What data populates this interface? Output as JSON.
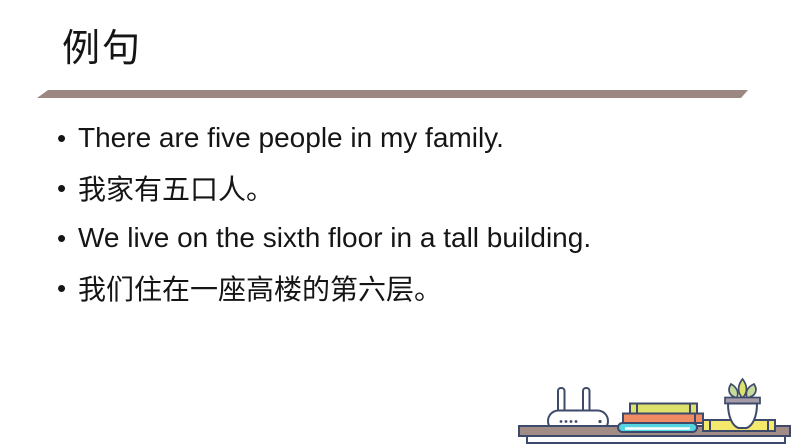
{
  "slide": {
    "title": "例句",
    "bullet_char": "•",
    "lines": [
      {
        "text": "There are five people in my family."
      },
      {
        "text": "我家有五口人。"
      },
      {
        "text": "We live on the sixth floor in a tall building."
      },
      {
        "text": "我们住在一座高楼的第六层。"
      }
    ],
    "palette": {
      "text_black": "#151515",
      "divider_taupe": "#9c8781",
      "outline_navy": "#3d4a6b",
      "table_taupe": "#a18d86",
      "book_top_yellow_green": "#dde26a",
      "book_middle_orange": "#f08c63",
      "book_bottom_cyan": "#55d5e2",
      "book_flat_yellow": "#f5e96d",
      "leaf_outer_green": "#c6da9b",
      "leaf_inner_yellow_green": "#dde26a",
      "pot_rim_gray": "#a59ca8",
      "pot_white": "#ffffff"
    },
    "decoration_items": [
      "wifi-router",
      "stack-of-books",
      "potted-plant",
      "flat-book",
      "shelf"
    ]
  }
}
